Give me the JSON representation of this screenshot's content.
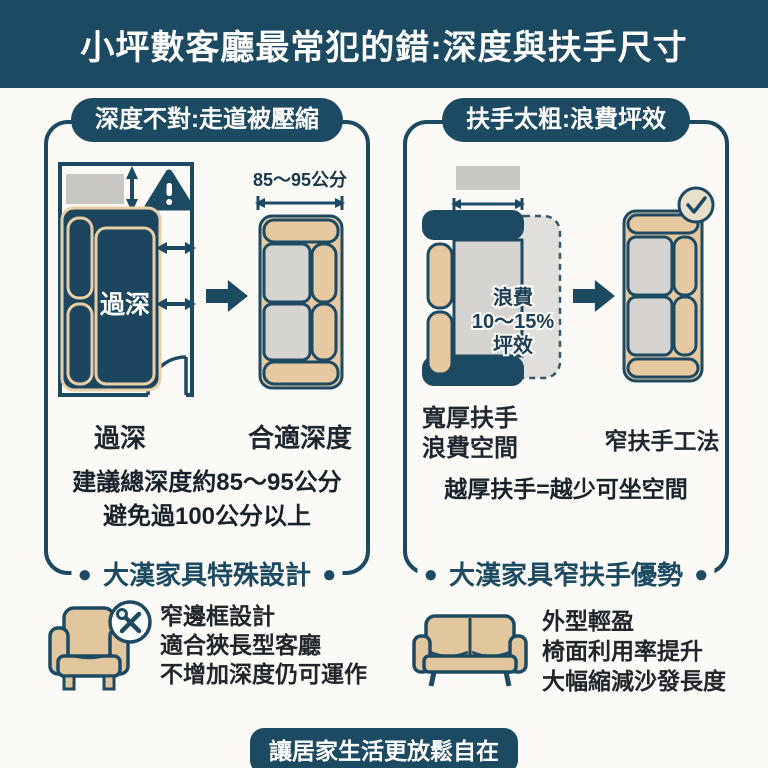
{
  "ui": {
    "dot": "●"
  },
  "header": {
    "title": "小坪數客廳最常犯的錯:深度與扶手尺寸"
  },
  "left_panel": {
    "badge": "深度不對:走道被壓縮",
    "diagram_bad": {
      "sofa_label": "過深"
    },
    "diagram_good": {
      "measure": "85〜95公分"
    },
    "caption_bad": "過深",
    "caption_good": "合適深度",
    "note_line1": "建議總深度約85〜95公分",
    "note_line2": "避免過100公分以上",
    "section_title": "大漢家具特殊設計",
    "feature": {
      "lines": [
        "窄邊框設計",
        "適合狹長型客廳",
        "不增加深度仍可運作"
      ]
    }
  },
  "right_panel": {
    "badge": "扶手太粗:浪費坪效",
    "diagram_bad": {
      "waste_line1": "浪費",
      "waste_line2": "10〜15%",
      "waste_line3": "坪效"
    },
    "caption_bad_line1": "寬厚扶手",
    "caption_bad_line2": "浪費空間",
    "caption_good": "窄扶手工法",
    "note": "越厚扶手=越少可坐空間",
    "section_title": "大漢家具窄扶手優勢",
    "feature": {
      "lines": [
        "外型輕盈",
        "椅面利用率提升",
        "大幅縮減沙發長度"
      ]
    }
  },
  "footer": {
    "text": "讓居家生活更放鬆自在"
  },
  "colors": {
    "navy": "#1d4a63",
    "sofa_navy": "#1c4560",
    "beige": "#e6c9a0",
    "gray": "#d5d4d1",
    "bg": "#fbfaf6"
  }
}
